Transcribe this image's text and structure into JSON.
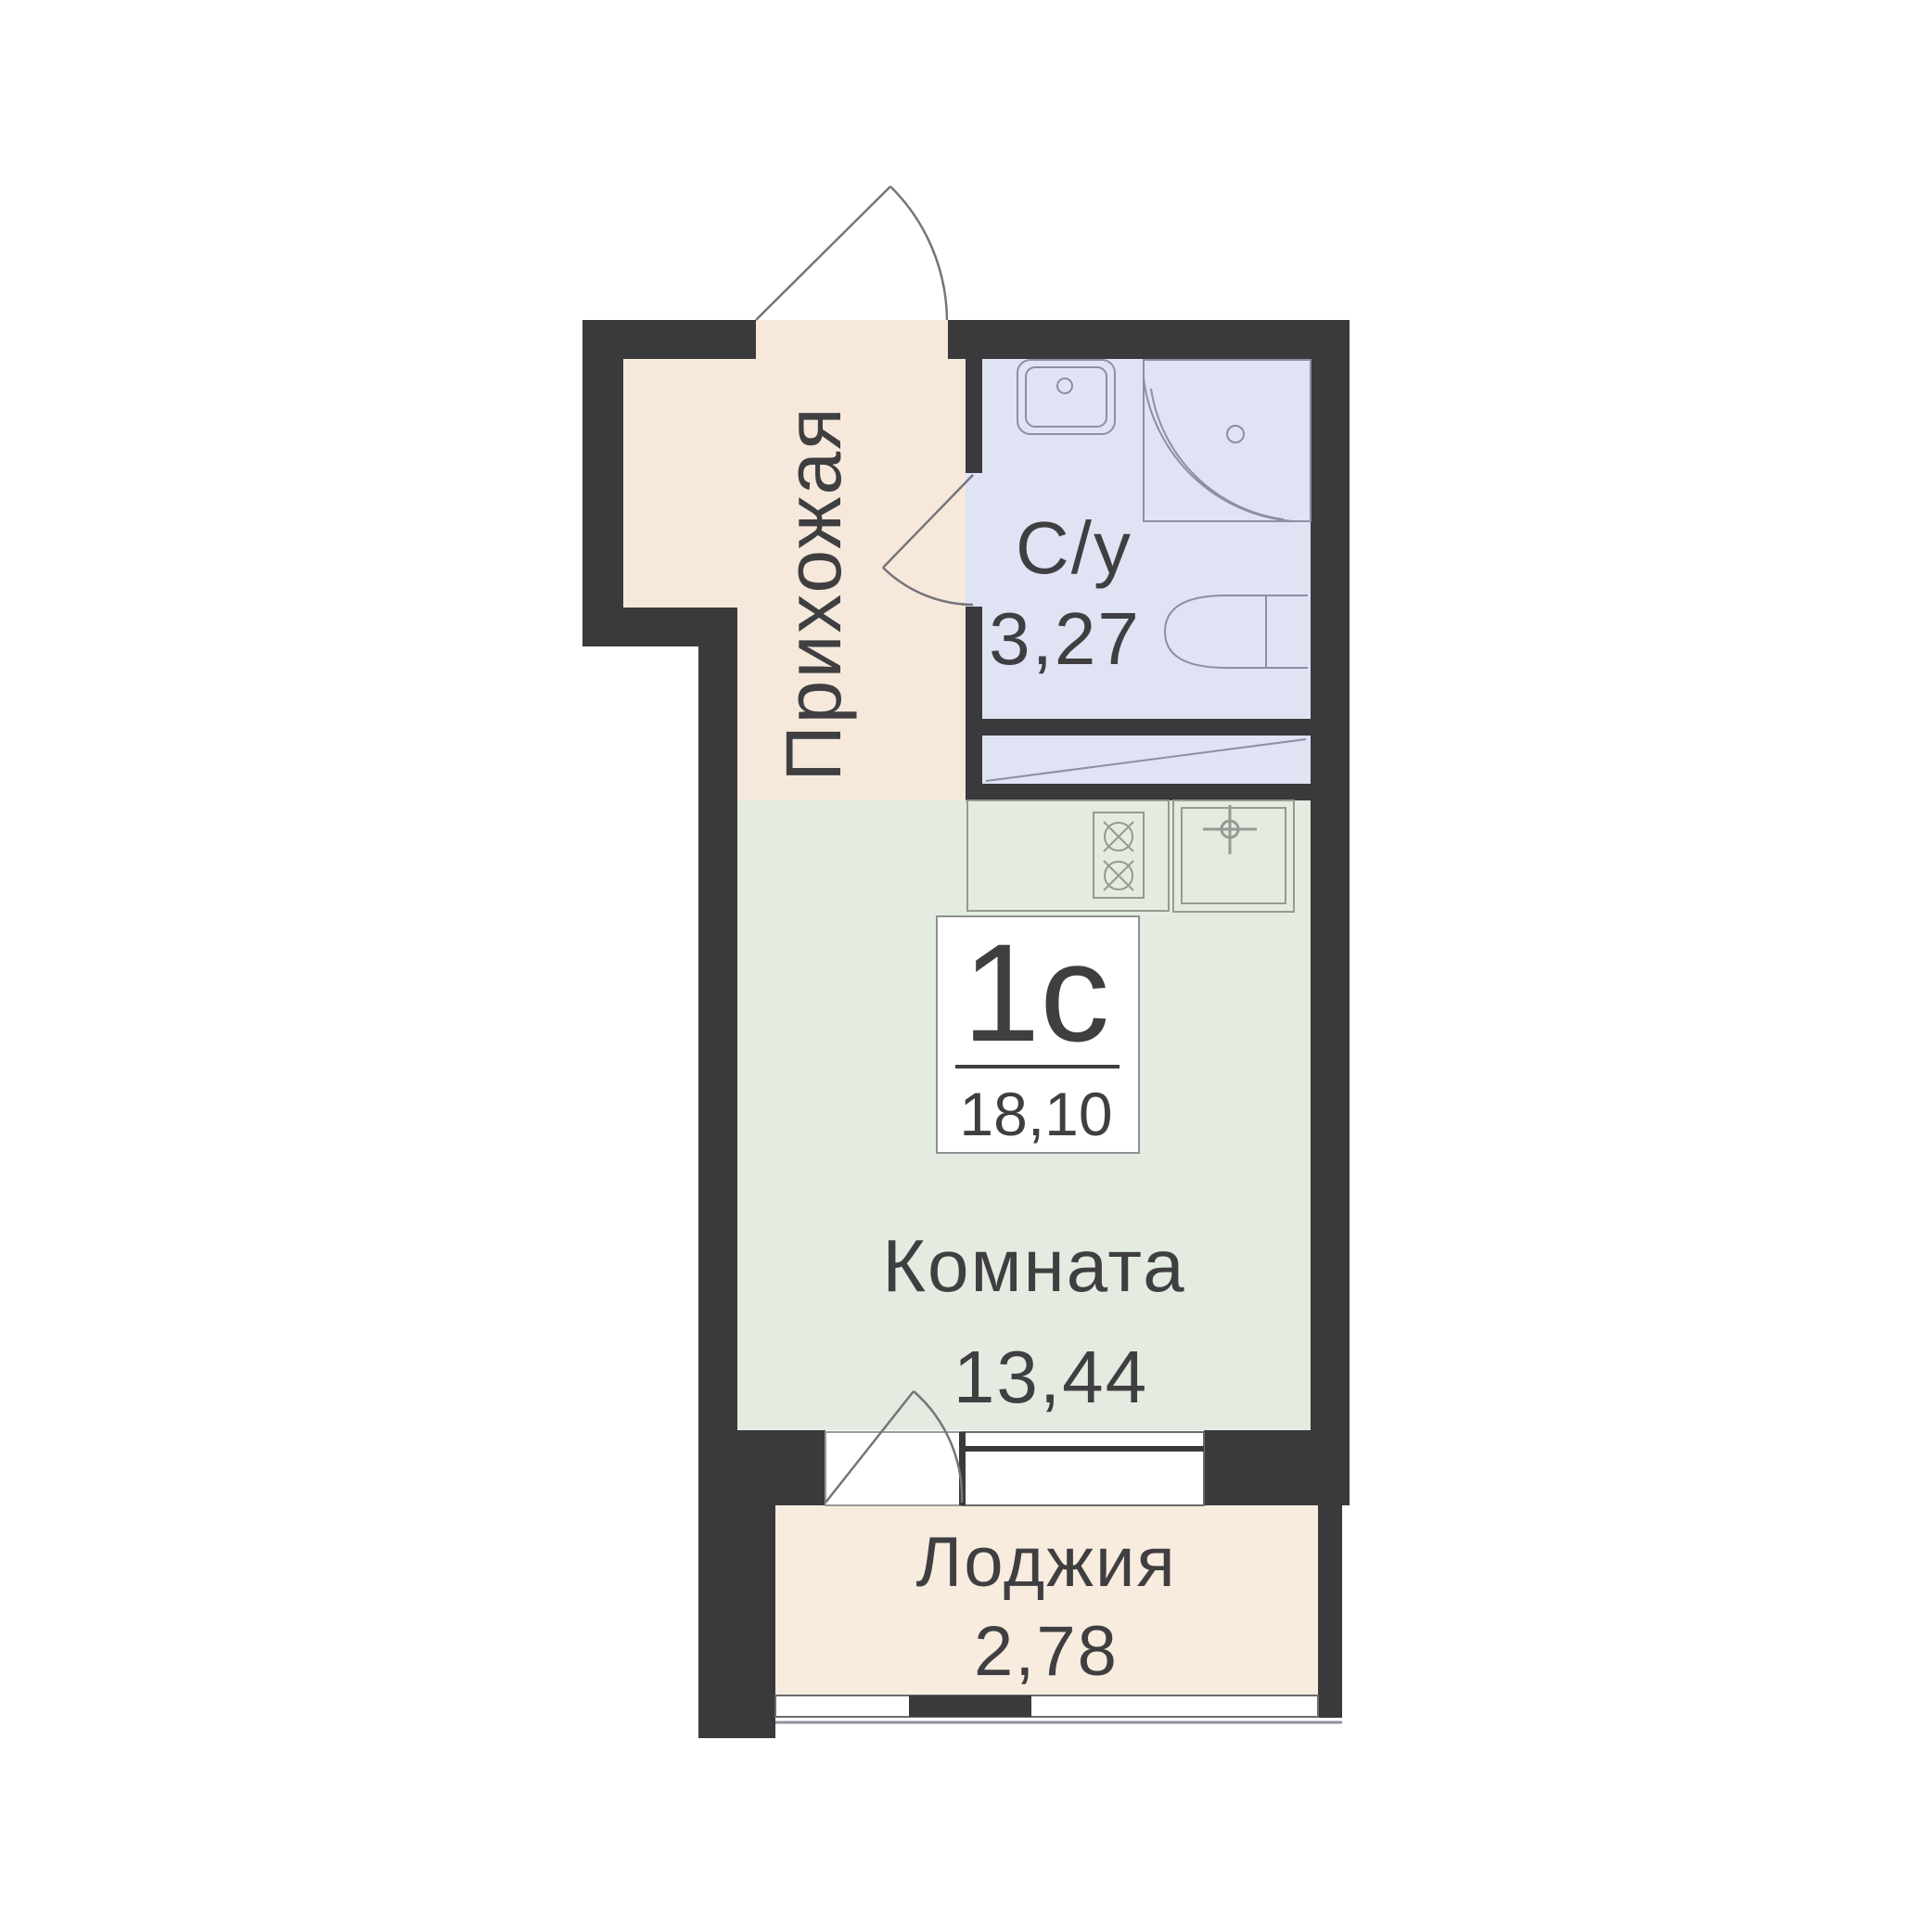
{
  "unit": {
    "type_label": "1с",
    "total_area": "18,10"
  },
  "rooms": {
    "hallway": {
      "label": "Прихожая"
    },
    "bathroom": {
      "label": "С/у",
      "area": "3,27"
    },
    "living": {
      "label": "Комната",
      "area": "13,44"
    },
    "loggia": {
      "label": "Лоджия",
      "area": "2,78"
    }
  },
  "colors": {
    "wall": "#3a3a3c",
    "hallway_floor": "#f6e9db",
    "bathroom_floor": "#dfe3f4",
    "living_floor": "#e4ebe0",
    "loggia_floor": "#f8ecdf",
    "fixture_line": "#8a8f98",
    "door_line": "#75757a",
    "text": "#3f3f41",
    "opening_white": "#ffffff"
  }
}
